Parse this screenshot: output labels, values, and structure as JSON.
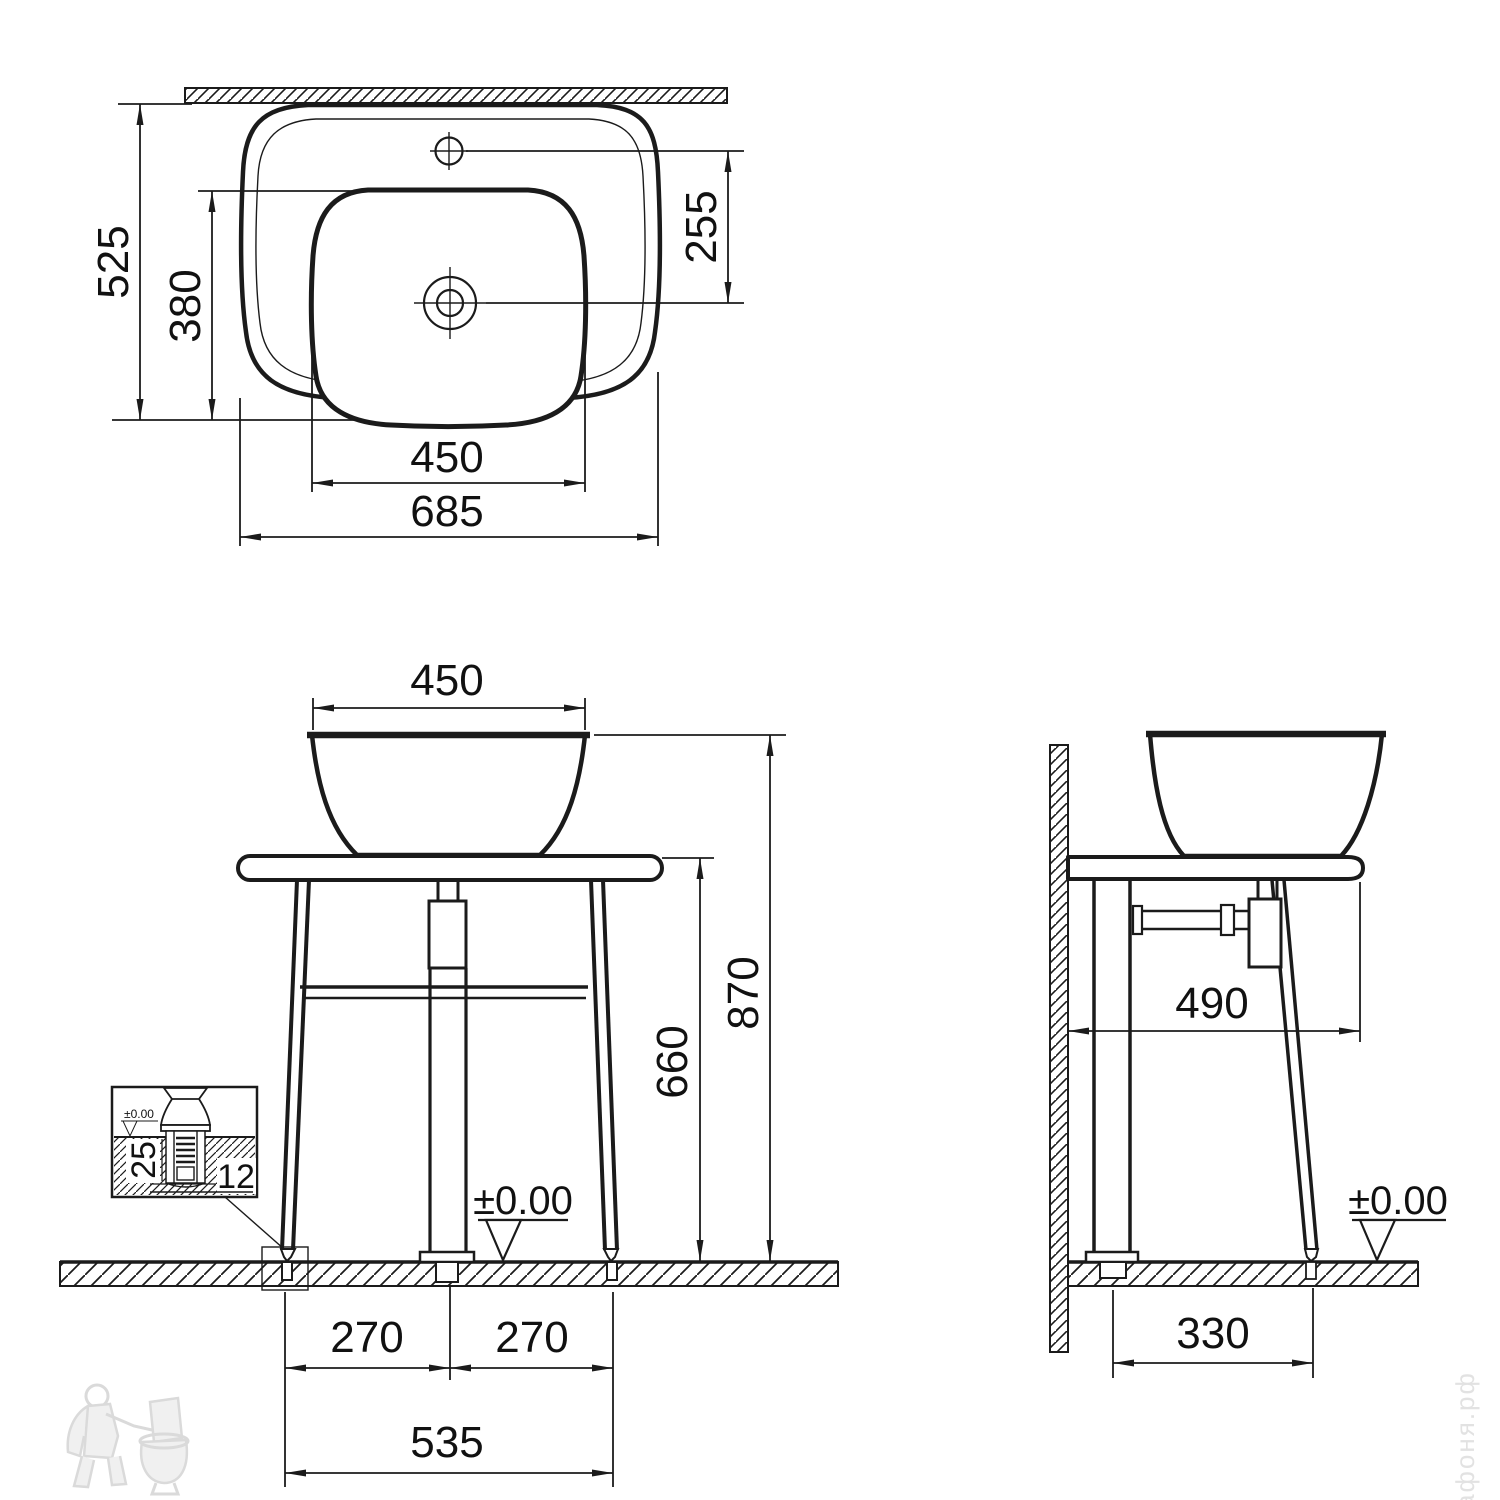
{
  "colors": {
    "ink": "#1b1b1b",
    "paper": "#ffffff",
    "watermark": "#d9d9d9"
  },
  "top": {
    "overall_width": "685",
    "overall_depth": "525",
    "basin_width": "450",
    "basin_depth": "380",
    "faucet_to_drain": "255"
  },
  "front": {
    "basin_width": "450",
    "total_height": "870",
    "table_height": "660",
    "spacing_left": "270",
    "spacing_right": "270",
    "anchor_span": "535",
    "level": "±0.00",
    "detail_depth": "25",
    "detail_bolt": "12",
    "detail_level": "±0.00"
  },
  "side": {
    "table_depth": "490",
    "anchor_span": "330",
    "level": "±0.00"
  },
  "watermark": {
    "site": "афоня.рф"
  }
}
